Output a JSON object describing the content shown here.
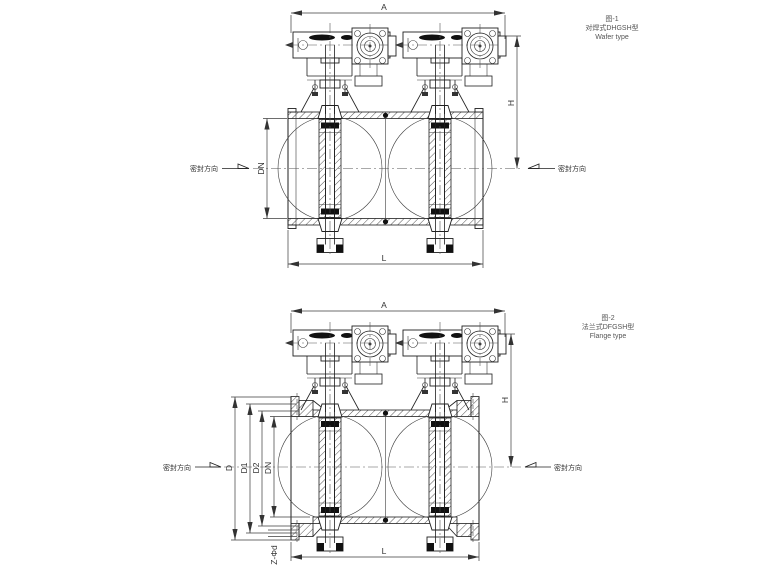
{
  "fig1": {
    "caption1": "图-1",
    "caption2": "对焊式DHGSH型",
    "caption3": "Wafer type",
    "dim_a": "A",
    "dim_h": "H",
    "dim_dn": "DN",
    "dim_l": "L",
    "seal_left": "密封方向",
    "seal_right": "密封方向"
  },
  "fig2": {
    "caption1": "图-2",
    "caption2": "法兰式DFGSH型",
    "caption3": "Flange type",
    "dim_a": "A",
    "dim_h": "H",
    "dim_d": "D",
    "dim_d1": "D1",
    "dim_d2": "D2",
    "dim_dn": "DN",
    "dim_l": "L",
    "dim_z": "Z-Φd",
    "seal_left": "密封方向",
    "seal_right": "密封方向"
  },
  "colors": {
    "line": "#1f1f1f",
    "thin": "#3c3c3c",
    "text": "#333333",
    "background": "#ffffff"
  }
}
